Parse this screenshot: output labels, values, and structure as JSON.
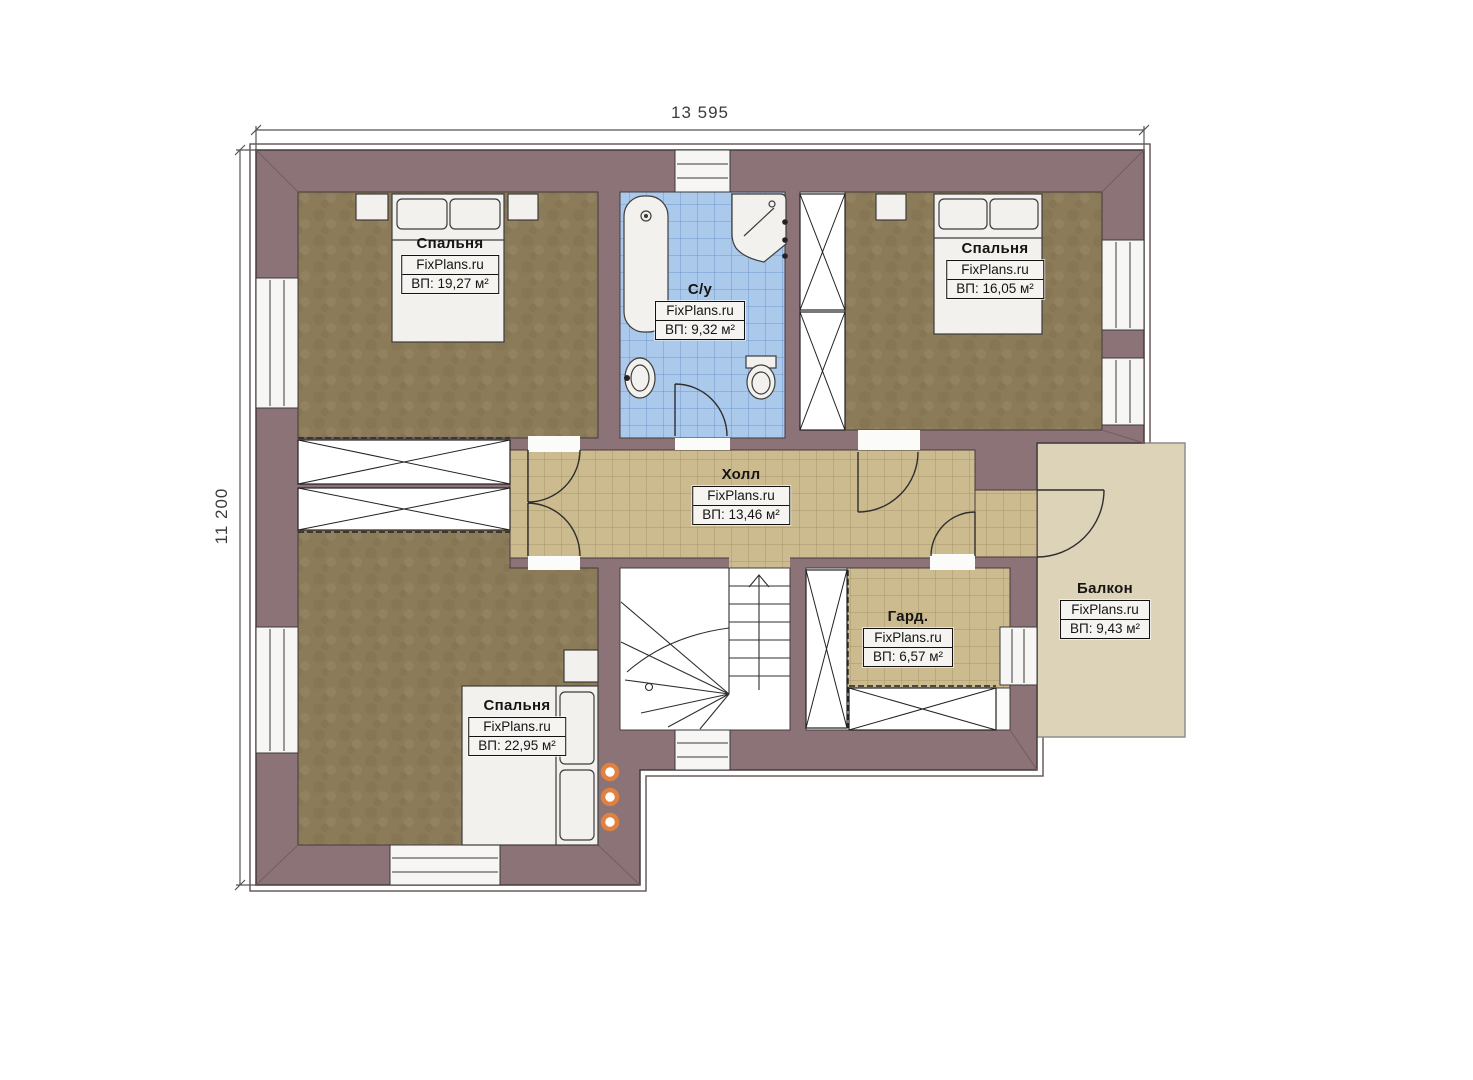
{
  "plan": {
    "dimensions": {
      "width_label": "13 595",
      "height_label": "11 200"
    },
    "rooms": {
      "bedroom_tl": {
        "name": "Спальня",
        "brand": "FixPlans.ru",
        "area": "ВП: 19,27 м²"
      },
      "bedroom_tr": {
        "name": "Спальня",
        "brand": "FixPlans.ru",
        "area": "ВП: 16,05 м²"
      },
      "bathroom": {
        "name": "С/у",
        "brand": "FixPlans.ru",
        "area": "ВП: 9,32 м²"
      },
      "hall": {
        "name": "Холл",
        "brand": "FixPlans.ru",
        "area": "ВП: 13,46 м²"
      },
      "wardrobe": {
        "name": "Гард.",
        "brand": "FixPlans.ru",
        "area": "ВП: 6,57 м²"
      },
      "balcony": {
        "name": "Балкон",
        "brand": "FixPlans.ru",
        "area": "ВП: 9,43 м²"
      },
      "bedroom_bl": {
        "name": "Спальня",
        "brand": "FixPlans.ru",
        "area": "ВП: 22,95 м²"
      }
    },
    "colors": {
      "wall": "#8b7377",
      "bedroom_floor": "#8c7b58",
      "hall_tile": "#cdbb90",
      "bath_tile": "#abc9eb",
      "balcony_floor": "#ddd3b9",
      "accent_light": "#e0813f"
    }
  }
}
